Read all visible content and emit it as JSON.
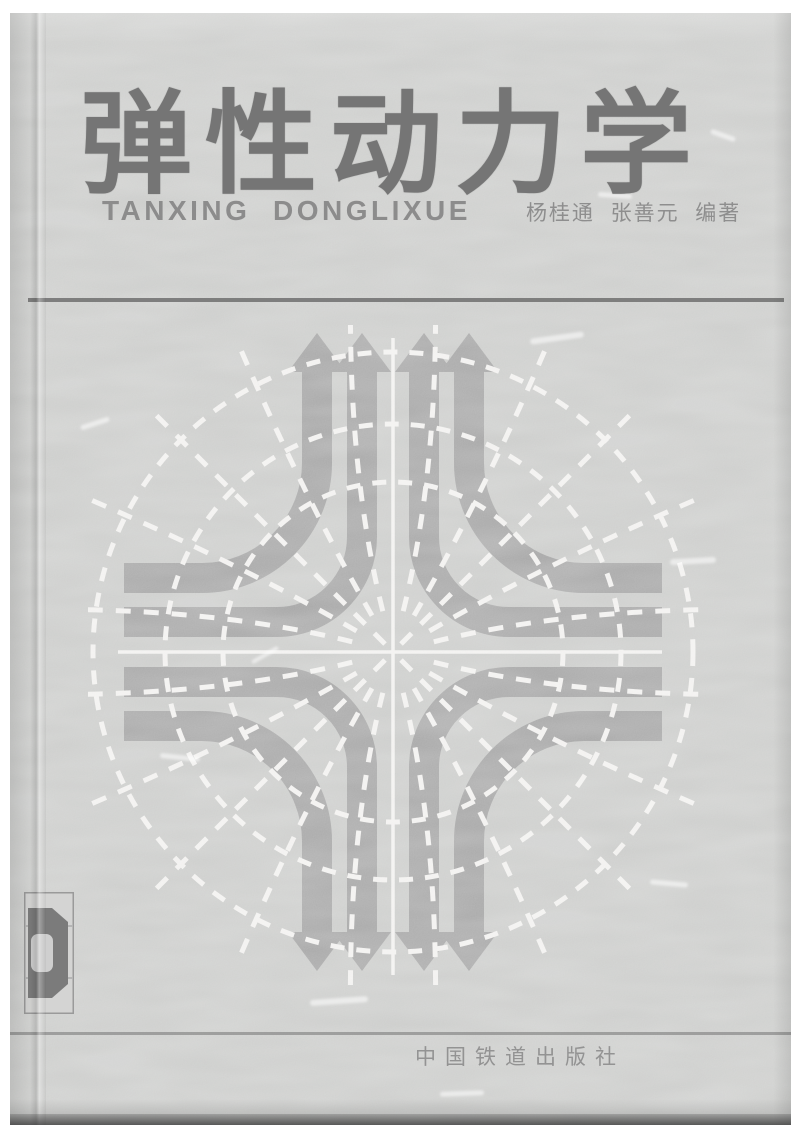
{
  "cover": {
    "title": "弹性动力学",
    "pinyin": "TANXING  DONGLIXUE",
    "authors": "杨桂通  张善元  编著",
    "publisher": "中国铁道出版社"
  },
  "artwork": {
    "name": "four-way-turning-arrows-with-dashed-trajectories",
    "elements": [
      "up-arrows",
      "down-arrows",
      "left-right-band-ends",
      "white-center-cross",
      "dashed-diagonals",
      "dashed-radial-rays",
      "dashed-concentric-arcs"
    ]
  },
  "colors": {
    "scan_margin": "#ffffff",
    "cover_bg": "#c5c6c4",
    "band_gray": "#9b9b9b",
    "line_white": "#f0efed",
    "title_gray": "#757575",
    "text_gray": "#8e8e8e",
    "rule_gray": "#6e6e6e"
  }
}
